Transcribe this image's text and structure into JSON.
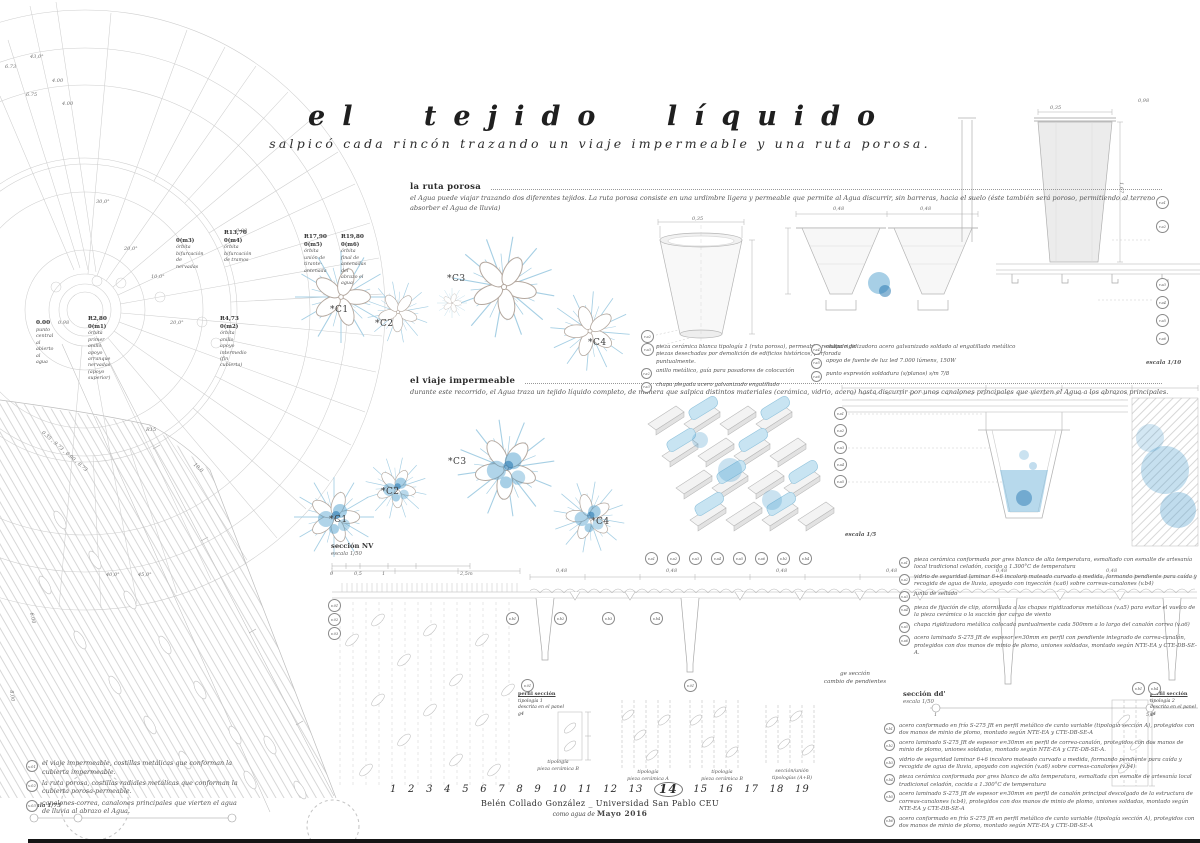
{
  "title": {
    "main": "el tejido líquido",
    "subtitle": "salpicó cada rincón trazando un viaje impermeable y una ruta porosa."
  },
  "sections": {
    "ruta_porosa": {
      "heading": "la ruta porosa",
      "body": "el Agua puede viajar trazando dos diferentes tejidos. La ruta porosa consiste en una urdimbre ligera y permeable que permite al Agua discurrir, sin barreras, hacia el suelo (éste también será poroso, permitiendo al terreno absorber el Agua de lluvia)"
    },
    "viaje_impermeable": {
      "heading": "el viaje impermeable",
      "body": "durante este recorrido, el Agua traza un tejido líquido completo, de manera que salpica distintos materiales (cerámica, vidrio, acero) hasta discurrir por unos canalones principales que vierten el Agua a los abrazos principales."
    }
  },
  "plan_labels": [
    {
      "big": "0.00",
      "code": "",
      "d1": "punto central al",
      "d2": "abierto al agua",
      "x": 36,
      "y": 320
    },
    {
      "big": "R2,80",
      "code": "0(m1)",
      "d1": "órbita primer anillo apoyo",
      "d2": "arranque nervadas (apoyo superior)",
      "x": 88,
      "y": 316
    },
    {
      "big": "R4,73",
      "code": "0(m2)",
      "d1": "órbita anillo apoyo",
      "d2": "intermedio (fin cubierta)",
      "x": 220,
      "y": 316
    },
    {
      "big": "",
      "code": "0(m3)",
      "d1": "órbita bifurcación",
      "d2": "de nervadas",
      "x": 176,
      "y": 238
    },
    {
      "big": "R13,70",
      "code": "0(m4)",
      "d1": "órbita bifurcación",
      "d2": "de tramos",
      "x": 224,
      "y": 230
    },
    {
      "big": "R17,90",
      "code": "0(m5)",
      "d1": "órbita unión de",
      "d2": "tirante-antenada",
      "x": 304,
      "y": 234
    },
    {
      "big": "R19,80",
      "code": "0(m6)",
      "d1": "órbita final de antenadas",
      "d2": "del abrazo el agua",
      "x": 341,
      "y": 234
    }
  ],
  "flower_labels": [
    {
      "t": "*C1",
      "x": 330,
      "y": 305
    },
    {
      "t": "*C2",
      "x": 375,
      "y": 319
    },
    {
      "t": "*C3",
      "x": 447,
      "y": 274
    },
    {
      "t": "*C4",
      "x": 588,
      "y": 338
    },
    {
      "t": "*C1",
      "x": 329,
      "y": 515
    },
    {
      "t": "*C2",
      "x": 381,
      "y": 487
    },
    {
      "t": "*C3",
      "x": 448,
      "y": 457
    },
    {
      "t": "*C4",
      "x": 591,
      "y": 517
    }
  ],
  "dims": [
    {
      "t": "43,0°",
      "x": 30,
      "y": 54
    },
    {
      "t": "6.73",
      "x": 5,
      "y": 64
    },
    {
      "t": "4.00",
      "x": 52,
      "y": 78
    },
    {
      "t": "6.75",
      "x": 26,
      "y": 92
    },
    {
      "t": "4.00",
      "x": 62,
      "y": 101
    },
    {
      "t": "9.00",
      "x": 236,
      "y": 228
    },
    {
      "t": "20,0°",
      "x": 124,
      "y": 246
    },
    {
      "t": "10,0°",
      "x": 151,
      "y": 274
    },
    {
      "t": "20,0°",
      "x": 170,
      "y": 320
    },
    {
      "t": "30,0°",
      "x": 96,
      "y": 199
    },
    {
      "t": "0.98",
      "x": 58,
      "y": 320
    },
    {
      "t": "R15",
      "x": 146,
      "y": 427
    },
    {
      "t": "0.35 , 9.73 , 6.00 , 8.73",
      "x": 44,
      "y": 430,
      "r": 41
    },
    {
      "t": "10,0",
      "x": 196,
      "y": 462,
      "r": 43
    },
    {
      "t": "40,0°",
      "x": 106,
      "y": 572
    },
    {
      "t": "45,0°",
      "x": 138,
      "y": 572
    },
    {
      "t": "6.00",
      "x": 34,
      "y": 612,
      "r": 78
    },
    {
      "t": "8.00",
      "x": 14,
      "y": 690,
      "r": 83
    },
    {
      "t": "0,35",
      "x": 692,
      "y": 216
    },
    {
      "t": "0,48",
      "x": 833,
      "y": 206
    },
    {
      "t": "0,48",
      "x": 920,
      "y": 206
    },
    {
      "t": "0,35",
      "x": 1050,
      "y": 105
    },
    {
      "t": "0,98",
      "x": 1138,
      "y": 98
    },
    {
      "t": "1,67",
      "x": 1124,
      "y": 182,
      "r": 90
    },
    {
      "t": "0",
      "x": 330,
      "y": 571
    },
    {
      "t": "0,5",
      "x": 354,
      "y": 571
    },
    {
      "t": "1",
      "x": 382,
      "y": 571
    },
    {
      "t": "2,5m",
      "x": 460,
      "y": 571
    },
    {
      "t": "0,48",
      "x": 556,
      "y": 568
    },
    {
      "t": "0,48",
      "x": 666,
      "y": 568
    },
    {
      "t": "0,48",
      "x": 776,
      "y": 568
    },
    {
      "t": "0,48",
      "x": 886,
      "y": 568
    },
    {
      "t": "0,48",
      "x": 996,
      "y": 568
    },
    {
      "t": "0,48",
      "x": 1106,
      "y": 568
    },
    {
      "t": "1",
      "x": 934,
      "y": 712
    },
    {
      "t": "5,0",
      "x": 1146,
      "y": 712
    }
  ],
  "markers": [
    {
      "c": "r.a2",
      "x": 641,
      "y": 330
    },
    {
      "c": "r.a3",
      "x": 641,
      "y": 343
    },
    {
      "c": "r.a1",
      "x": 1156,
      "y": 196
    },
    {
      "c": "r.a2",
      "x": 1156,
      "y": 220
    },
    {
      "c": "r.a3",
      "x": 1156,
      "y": 278
    },
    {
      "c": "r.a4",
      "x": 1156,
      "y": 296
    },
    {
      "c": "r.a5",
      "x": 1156,
      "y": 314
    },
    {
      "c": "r.a6",
      "x": 1156,
      "y": 332
    },
    {
      "c": "v.a1",
      "x": 834,
      "y": 407
    },
    {
      "c": "v.a2",
      "x": 834,
      "y": 424
    },
    {
      "c": "v.a3",
      "x": 834,
      "y": 441
    },
    {
      "c": "v.a4",
      "x": 834,
      "y": 458
    },
    {
      "c": "v.a5",
      "x": 834,
      "y": 475
    },
    {
      "c": "v.a1",
      "x": 645,
      "y": 552
    },
    {
      "c": "v.a2",
      "x": 667,
      "y": 552
    },
    {
      "c": "v.a3",
      "x": 689,
      "y": 552
    },
    {
      "c": "v.a4",
      "x": 711,
      "y": 552
    },
    {
      "c": "v.a5",
      "x": 733,
      "y": 552
    },
    {
      "c": "v.a6",
      "x": 755,
      "y": 552
    },
    {
      "c": "v.b2",
      "x": 777,
      "y": 552
    },
    {
      "c": "v.b4",
      "x": 799,
      "y": 552
    },
    {
      "c": "v.b1",
      "x": 506,
      "y": 612
    },
    {
      "c": "v.b2",
      "x": 554,
      "y": 612
    },
    {
      "c": "v.b3",
      "x": 602,
      "y": 612
    },
    {
      "c": "v.b4",
      "x": 650,
      "y": 612
    },
    {
      "c": "v.01",
      "x": 328,
      "y": 599
    },
    {
      "c": "v.02",
      "x": 328,
      "y": 613
    },
    {
      "c": "v.03",
      "x": 328,
      "y": 627
    },
    {
      "c": "v.01",
      "x": 521,
      "y": 679
    },
    {
      "c": "v.01",
      "x": 684,
      "y": 679
    },
    {
      "c": "v.b1",
      "x": 1132,
      "y": 682
    },
    {
      "c": "v.b4",
      "x": 1148,
      "y": 682
    }
  ],
  "legend_ruta": {
    "scale": "escala 1/10",
    "left": [
      {
        "code": "r.a1",
        "text": "pieza cerámica blanca tipología 1 (ruta porosa), permeable, resultado de piezas desechadas por demolición de edificios históricos, perforada puntualmente."
      },
      {
        "code": "r.a2",
        "text": "anillo metálico, guía para pasadores de colocación"
      },
      {
        "code": "r.a3",
        "text": "chapa plegada acero galvanizado engatillado"
      }
    ],
    "right": [
      {
        "code": "r.a4",
        "text": "chapa rigidizadora acero galvanizado soldado al engatillado metálico"
      },
      {
        "code": "r.a5",
        "text": "apoyo de fuente de luz led 7.000 lúmens, 150W"
      },
      {
        "code": "r.a6",
        "text": "punto expresión soldadura (s/planos) s/m 7/8"
      }
    ]
  },
  "legend_va": {
    "scale": "escala 1/5",
    "items": [
      {
        "code": "v.a1",
        "text": "pieza cerámica conformada por gres blanco de alta temperatura, esmaltado con esmalte de artesanía local tradicional celadón, cocido a 1.300°C de temperatura"
      },
      {
        "code": "v.a2",
        "text": "vidrio de seguridad laminar 6+6 incoloro mateado curvado a medida, formando pendiente para caída y recogida de agua de lluvia, apoyado con inyección (v.a6) sobre correas-canalones (v.b4)"
      },
      {
        "code": "v.a3",
        "text": "junta de sellado"
      },
      {
        "code": "v.a4",
        "text": "pieza de fijación de clip, atornillada a las chapas rigidizadoras metálicas (v.a5) para evitar el vuelco de la pieza cerámica o la succión por carga de viento"
      },
      {
        "code": "v.a5",
        "text": "chapa rigidizadora metálica colocada puntualmente cada 500mm a lo largo del canalón correa (v.a6)"
      },
      {
        "code": "v.a6",
        "text": "acero laminado S-275 JR de espesor e≈30mm en perfil con pendiente integrado de correa-canalón, protegidos con dos manos de minio de plomo, uniones soldadas, montado según NTE-EA y CTE-DB-SE-A."
      }
    ]
  },
  "legend_vb": {
    "items": [
      {
        "code": "v.b1",
        "text": "acero conformado en frío S-275 JR en perfil metálico de canto variable (tipología sección A), protegidos con dos manos de minio de plomo, montado según NTE-EA y CTE-DB-SE-A"
      },
      {
        "code": "v.b2",
        "text": "acero laminado S-275 JR de espesor e≈30mm en perfil de correa-canalón, protegidos con dos manos de minio de plomo, uniones soldadas, montado según NTE-EA y CTE-DB-SE-A."
      },
      {
        "code": "v.b3",
        "text": "vidrio de seguridad laminar 6+6 incoloro mateado curvado a medida, formando pendiente para caída y recogida de agua de lluvia, apoyado con sujeción (v.a6) sobre correas-canalones (v.b4)"
      },
      {
        "code": "v.b4",
        "text": "pieza cerámica conformada por gres blanco de alta temperatura, esmaltada con esmalte de artesanía local tradicional celadón, cocida a 1.300°C de temperatura"
      },
      {
        "code": "v.b5",
        "text": "acero laminado S-275 JR de espesor e≈30mm en perfil de canalón principal descolgado de la estructura de correas-canalones (v.b4), protegidos con dos manos de minio de plomo, uniones soldadas, montado según NTE-EA y CTE-DB-SE-A"
      },
      {
        "code": "v.b6",
        "text": "acero conformado en frío S-275 JR en perfil metálico de canto variable (tipología sección A), protegidos con dos manos de minio de plomo, montado según NTE-EA y CTE-DB-SE-A"
      }
    ]
  },
  "legend_v0": {
    "scale": "escala 1/75",
    "items": [
      {
        "code": "v.01",
        "text": "el viaje impermeable, costillas metálicas que conforman la cubierta impermeable."
      },
      {
        "code": "v.02",
        "text": "la ruta porosa, costillas radiales metálicas que conforman la cubierta porosa-permeable."
      },
      {
        "code": "v.03",
        "text": "canalones-correa, canalones principales que vierten el agua de lluvia al abrazo el Agua."
      }
    ]
  },
  "section_labels": {
    "nv_title": "sección NV",
    "nv_scale": "escala 1/50",
    "dd_title": "sección dd'",
    "dd_scale": "escala 1/50",
    "ge_line1": "ge sección",
    "ge_line2": "cambio de pendientes",
    "perfil1": {
      "l1": "perfil sección",
      "l2": "tipología 1",
      "l3": "descrita en el panel g4"
    },
    "perfil2": {
      "l1": "perfil sección",
      "l2": "tipología 2",
      "l3": "descrita en el panel g4"
    }
  },
  "tipologia_labels": [
    {
      "l1": "tipología",
      "l2": "pieza cerámica B",
      "x": 528,
      "y": 760
    },
    {
      "l1": "tipología",
      "l2": "pieza cerámica A",
      "x": 618,
      "y": 770
    },
    {
      "l1": "tipología",
      "l2": "pieza cerámica B",
      "x": 692,
      "y": 770
    },
    {
      "l1": "sección/unión",
      "l2": "tipologías (A+B)",
      "x": 762,
      "y": 769
    }
  ],
  "footer": {
    "numbers": [
      {
        "n": "1"
      },
      {
        "n": "2"
      },
      {
        "n": "3"
      },
      {
        "n": "4"
      },
      {
        "n": "5"
      },
      {
        "n": "6"
      },
      {
        "n": "7"
      },
      {
        "n": "8"
      },
      {
        "n": "9"
      },
      {
        "n": "10"
      },
      {
        "n": "11"
      },
      {
        "n": "12"
      },
      {
        "n": "13"
      },
      {
        "n": "14",
        "cls": "cur"
      },
      {
        "n": "15"
      },
      {
        "n": "16"
      },
      {
        "n": "17"
      },
      {
        "n": "18"
      },
      {
        "n": "19"
      }
    ],
    "author": "Belén Collado González _ Universidad San Pablo CEU",
    "date_prefix": "como agua de",
    "date": "Mayo 2016"
  },
  "colors": {
    "flake_blue": "#a6cfe4",
    "water_blue": "#4f9fce",
    "line_gray": "#c7c7c7",
    "ink": "#1f1f1f"
  }
}
